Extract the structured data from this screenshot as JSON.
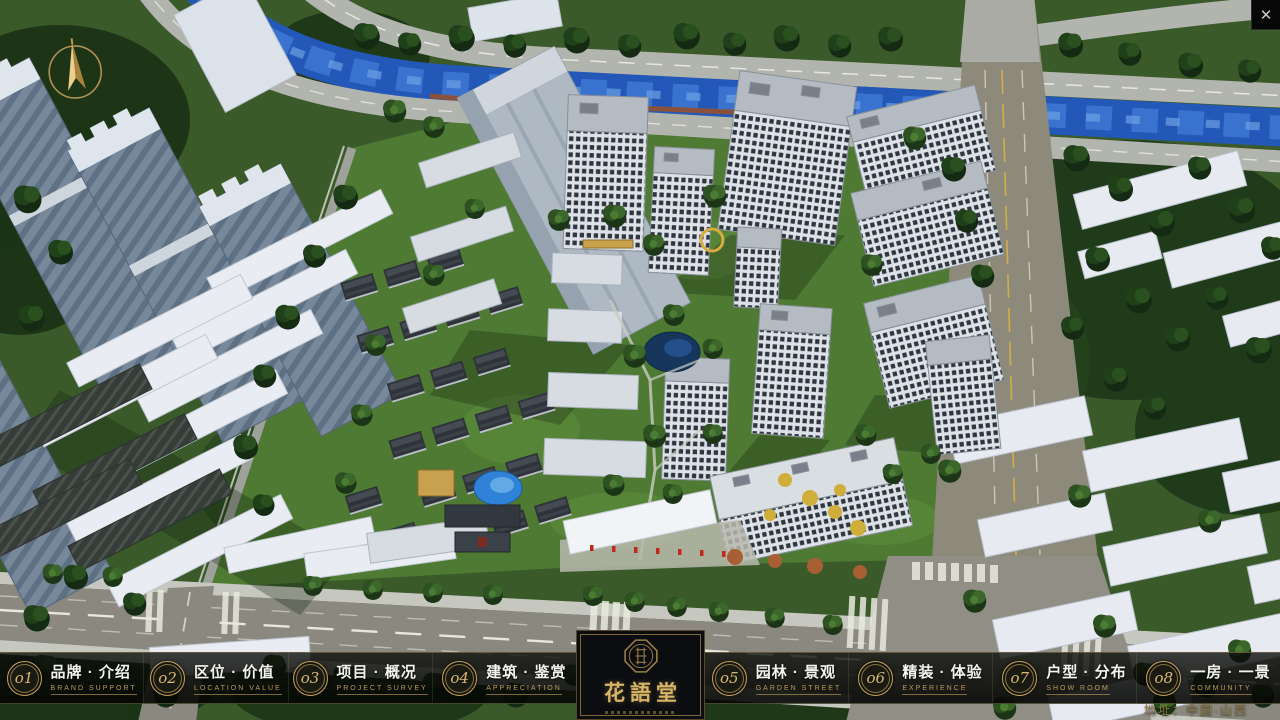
{
  "window": {
    "close": "✕"
  },
  "nav": {
    "items": [
      {
        "num": "o1",
        "title": "品牌 · 介绍",
        "subtitle": "BRAND SUPPORT"
      },
      {
        "num": "o2",
        "title": "区位 · 价值",
        "subtitle": "LOCATION VALUE"
      },
      {
        "num": "o3",
        "title": "项目 · 概况",
        "subtitle": "PROJECT SURVEY"
      },
      {
        "num": "o4",
        "title": "建筑 · 鉴赏",
        "subtitle": "APPRECIATION"
      },
      {
        "num": "o5",
        "title": "园林 · 景观",
        "subtitle": "GARDEN STREET"
      },
      {
        "num": "o6",
        "title": "精装 · 体验",
        "subtitle": "EXPERIENCE"
      },
      {
        "num": "o7",
        "title": "户型 · 分布",
        "subtitle": "SHOW ROOM"
      },
      {
        "num": "o8",
        "title": "一房 · 一景",
        "subtitle": "COMMUNITY"
      }
    ]
  },
  "logo": {
    "title": "花語堂"
  },
  "footer": {
    "address": "地址：中国·山西"
  },
  "colors": {
    "gold": "#c9a360",
    "bar_bg": "#0a0c09",
    "river": "#2458b8",
    "grass": "#4e7a33"
  }
}
